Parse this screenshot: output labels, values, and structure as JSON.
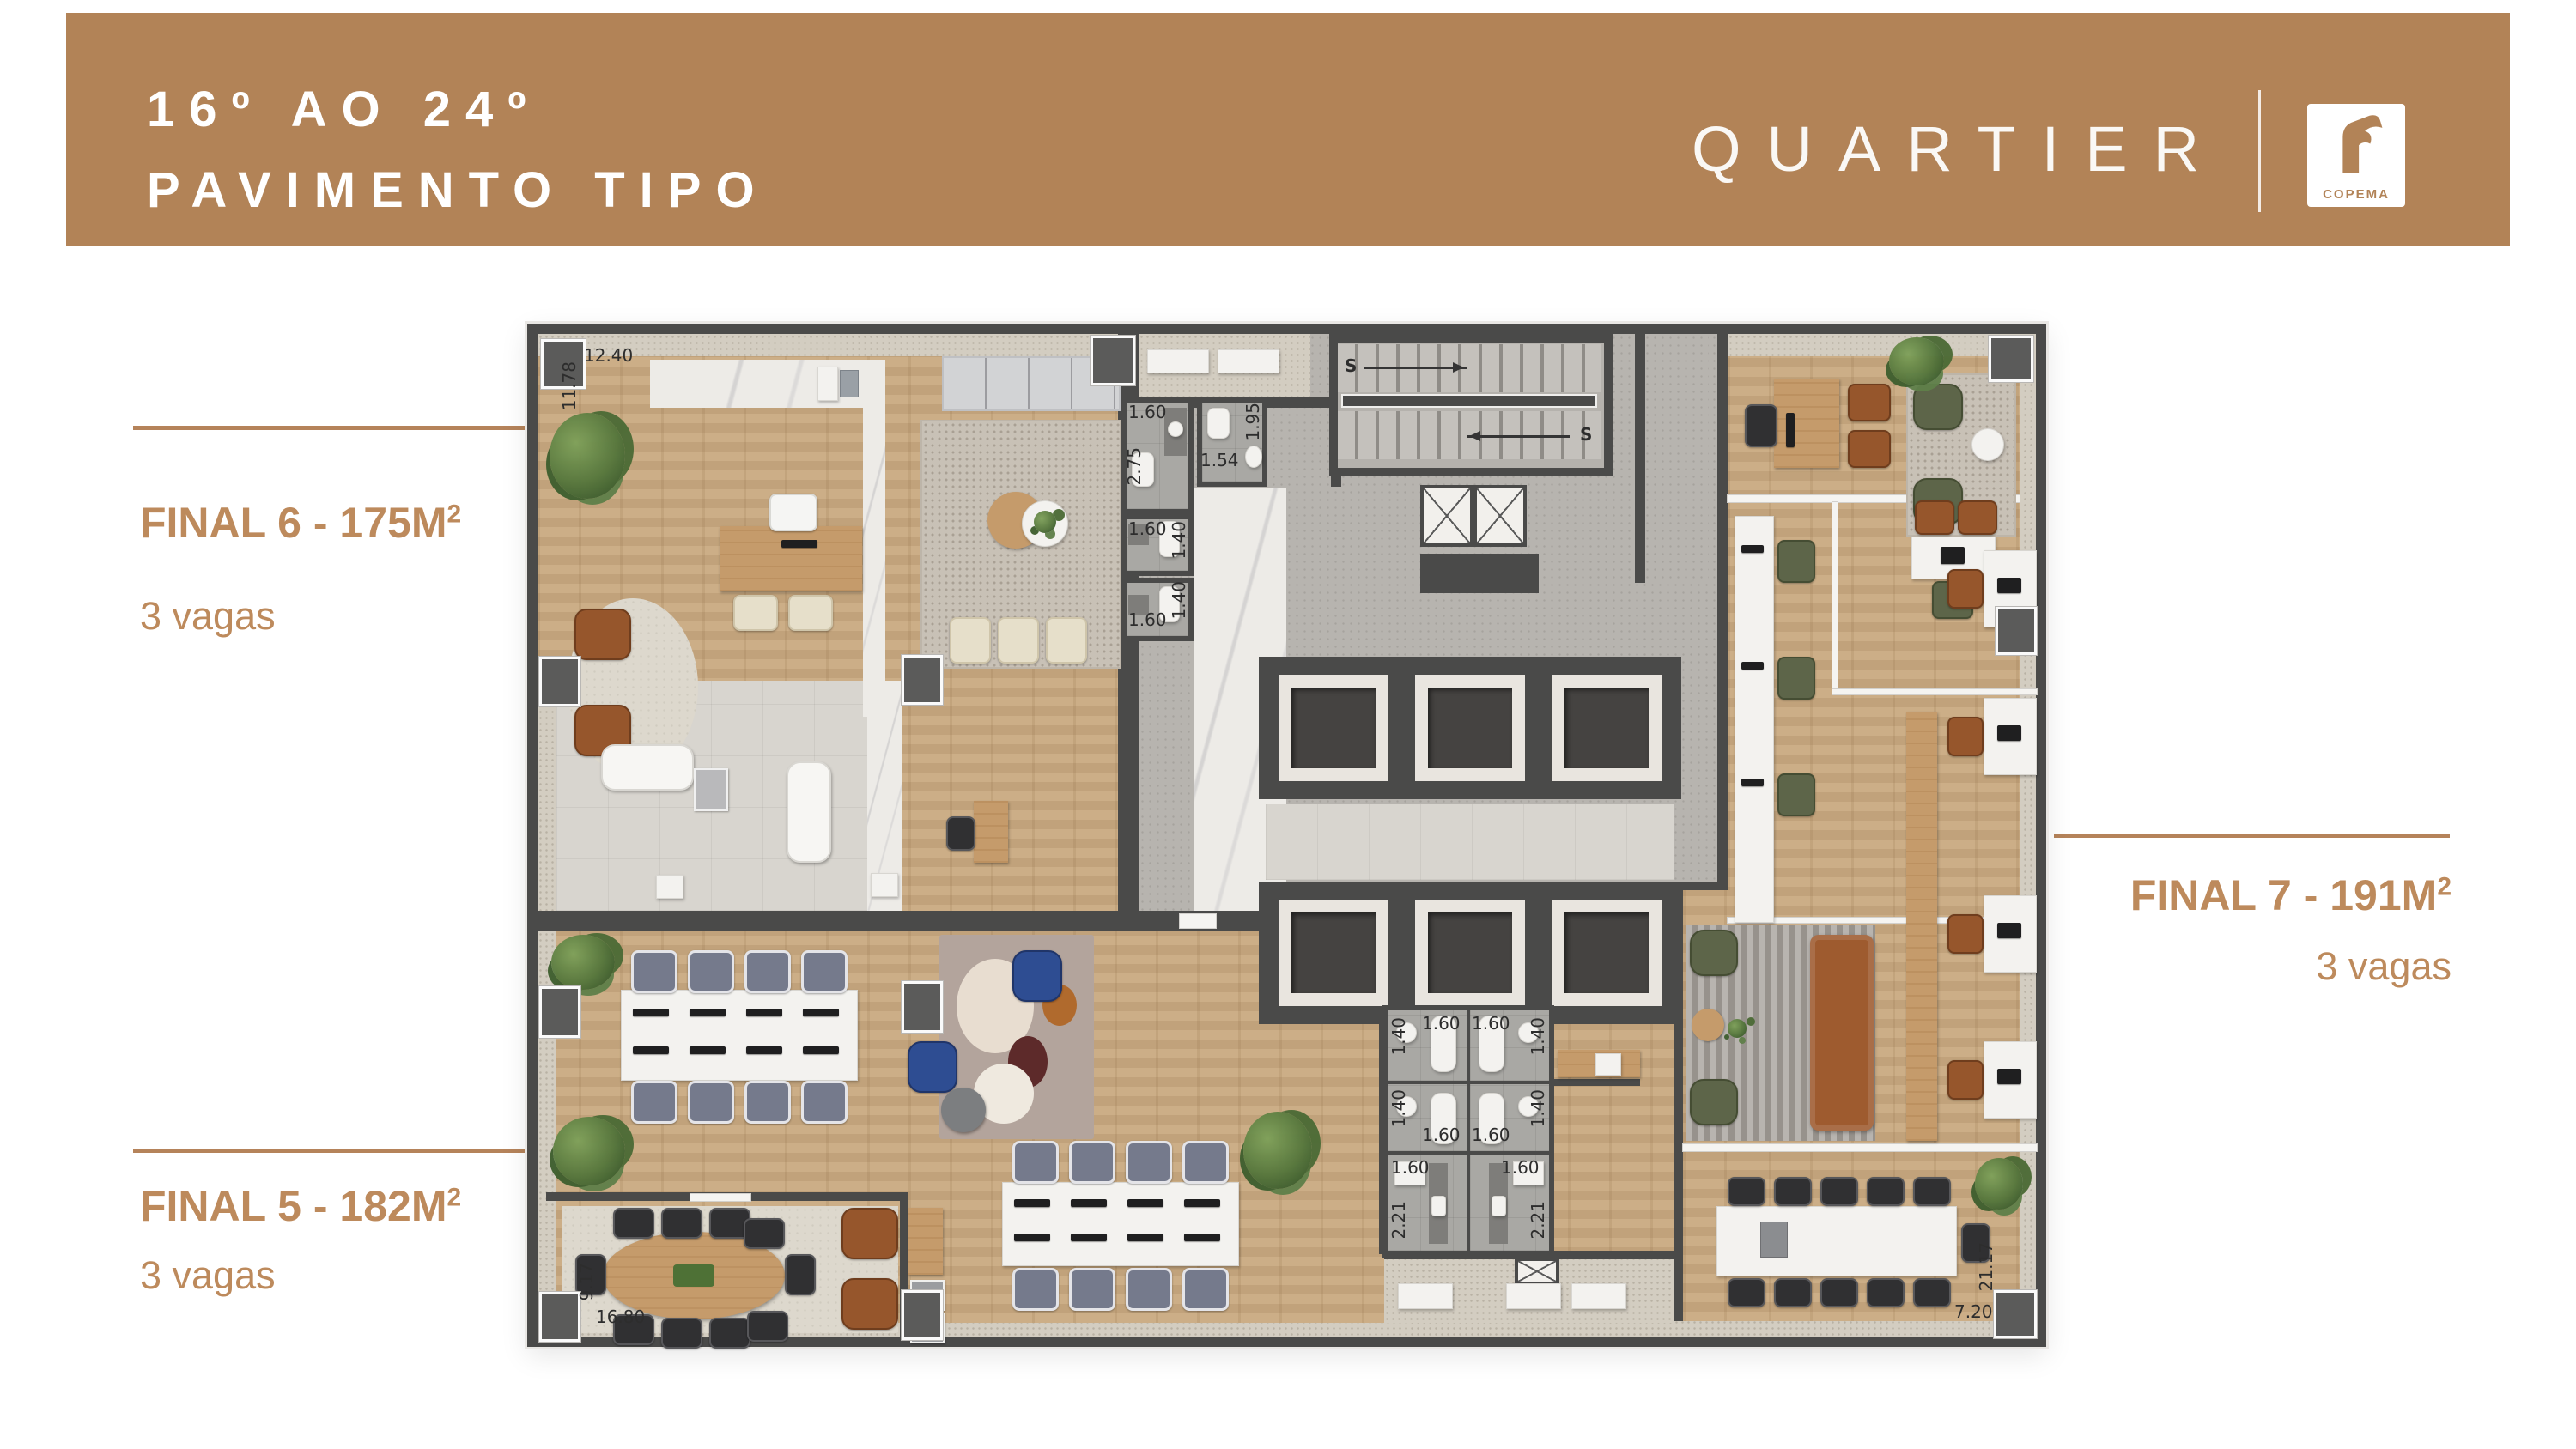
{
  "header": {
    "title_line1": "16º AO 24º",
    "title_line2": "PAVIMENTO TIPO",
    "brand_name": "QUARTIER",
    "partner_logo": "COPEMA"
  },
  "units": {
    "final6": {
      "area_label": "FINAL 6 - 175M",
      "area_sup": "2",
      "vagas": "3 vagas"
    },
    "final7": {
      "area_label": "FINAL 7 - 191M",
      "area_sup": "2",
      "vagas": "3 vagas"
    },
    "final5": {
      "area_label": "FINAL 5 - 182M",
      "area_sup": "2",
      "vagas": "3 vagas"
    }
  },
  "plan": {
    "stairs_up_label": "S",
    "dims": {
      "w1240": "12.40",
      "h1178": "11.78",
      "d275": "2.75",
      "d195": "1.95",
      "d160": "1.60",
      "d154": "1.54",
      "d140": "1.40",
      "d221": "2.21",
      "d917": "9.17",
      "d1680": "16.80",
      "d720": "7.20",
      "d2117": "21.17"
    }
  },
  "colors": {
    "banner_brown": "#b28357",
    "label_brown": "#bd8a5c",
    "wall_gray": "#4a4a49",
    "wood_floor": "#c9a980",
    "core_tile": "#c2bfb9",
    "white": "#ffffff"
  }
}
